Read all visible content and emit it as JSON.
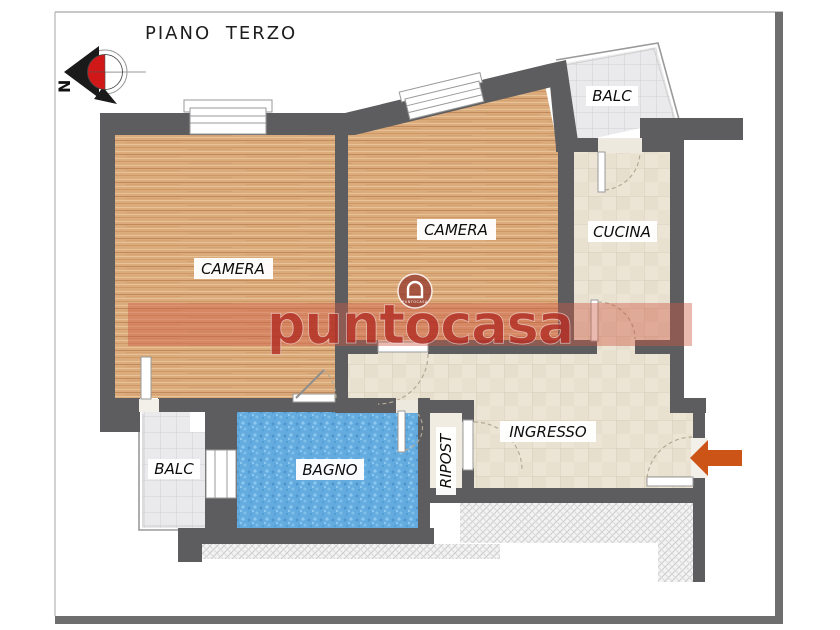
{
  "title": "PIANO TERZO",
  "compass": {
    "north_letter": "N"
  },
  "watermark": {
    "brand": "puntocasa",
    "logo_text": "PUNTOCASA"
  },
  "rooms": {
    "camera_left": {
      "label": "CAMERA"
    },
    "camera_mid": {
      "label": "CAMERA"
    },
    "cucina": {
      "label": "CUCINA"
    },
    "balc_top_right": {
      "label": "BALC"
    },
    "balc_bottom_left": {
      "label": "BALC"
    },
    "bagno": {
      "label": "BAGNO"
    },
    "ripost": {
      "label": "RIPOST"
    },
    "ingresso": {
      "label": "INGRESSO"
    }
  },
  "colors": {
    "wall": "#5d5d5f",
    "wood_floor": "#dcab7c",
    "tile_beige": "#ece5d6",
    "tile_gray": "#eaeaec",
    "tile_blue": "#64abdf",
    "watermark_red": "#b43426",
    "arrow_orange": "#cc5416",
    "compass_red": "#d01818",
    "frame_gray": "#6e6e6e"
  }
}
